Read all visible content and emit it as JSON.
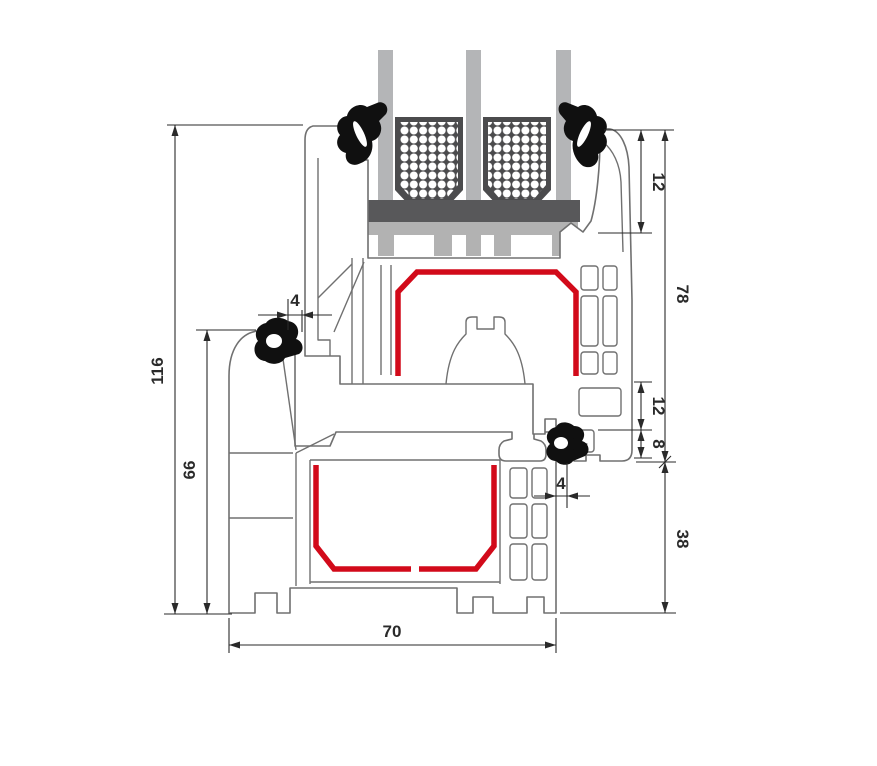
{
  "drawing": {
    "title": "uPVC window frame and sash profile cross-section with triple glazing",
    "dims": {
      "total_height": "116",
      "frame_height": "66",
      "frame_width": "70",
      "seal_gap_left": "4",
      "glazing_depth": "12",
      "sash_height": "78",
      "rebate_overlap": "12",
      "clearance": "8",
      "seal_gap_right": "4",
      "frame_lower_height": "38"
    },
    "colors": {
      "steel": "#d20a1a",
      "glass": "#b4b5b7",
      "spacer": "#4b4b4d",
      "setting_block": "#58585a",
      "bridge": "#b2b2b2",
      "profile_outline": "#707070",
      "dimension": "#2a2a2a",
      "gasket": "#101010",
      "background": "#ffffff"
    }
  }
}
